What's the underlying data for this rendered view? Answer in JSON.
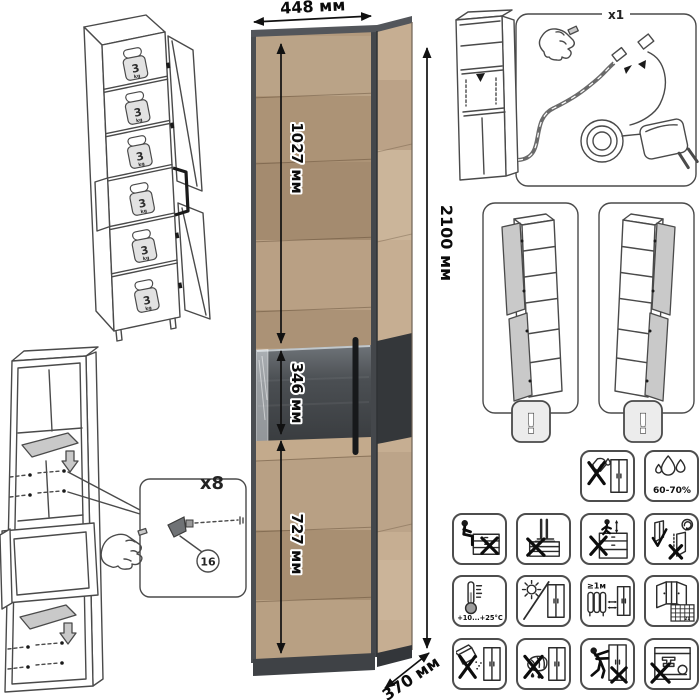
{
  "dimensions": {
    "width": "448 мм",
    "height": "2100 мм",
    "depth": "370 мм",
    "upper_door_height": "1027 мм",
    "niche_height": "346 мм",
    "lower_door_height": "727 мм"
  },
  "shelf_load": {
    "value": "3",
    "unit": "kg"
  },
  "assembly": {
    "fastener_count": "x8",
    "fastener_part_number": "16"
  },
  "led_kit": {
    "count": "x1"
  },
  "door_variants": {
    "warning_mark": "!"
  },
  "care": {
    "humidity_range": "60-70%",
    "temperature_range": "+10...+25°C",
    "heater_distance": "≥1м",
    "calendar_day": "21"
  },
  "colors": {
    "wood_front": "#b39a7d",
    "wood_side": "#c6ae92",
    "frame": "#4c4f53",
    "niche_dark": "#3b3e41",
    "line_art": "#4a4a4a"
  }
}
